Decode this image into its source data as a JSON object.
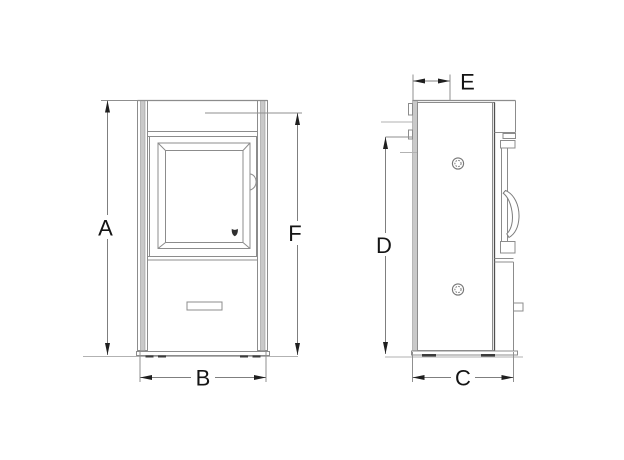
{
  "dimensions": {
    "A": {
      "label": "A"
    },
    "B": {
      "label": "B"
    },
    "C": {
      "label": "C"
    },
    "D": {
      "label": "D"
    },
    "E": {
      "label": "E"
    },
    "F": {
      "label": "F"
    }
  },
  "icons": {
    "window_logo": "window-logo-icon"
  },
  "colors": {
    "line": "#8c8c8c",
    "line_dark": "#4f4f4f",
    "panel_fill": "#c9c9c9",
    "arrow": "#1f1f1f",
    "text": "#141414",
    "background": "#ffffff"
  }
}
